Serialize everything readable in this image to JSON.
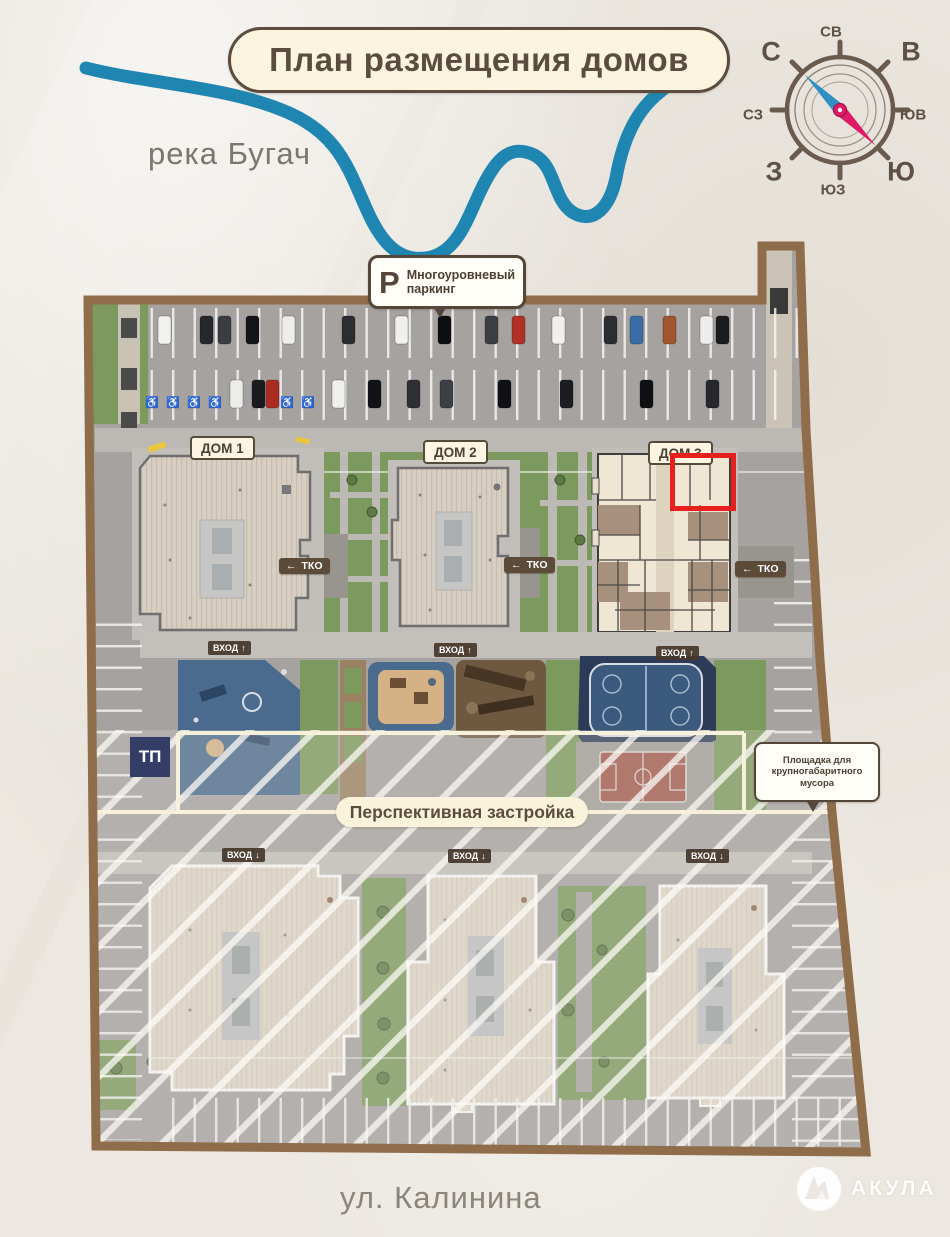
{
  "title": "План размещения домов",
  "labels": {
    "river": "река Бугач",
    "street": "ул. Калинина",
    "perspective": "Перспективная застройка",
    "tp": "ТП"
  },
  "compass": {
    "n": "С",
    "ne": "СВ",
    "e": "В",
    "se": "ЮВ",
    "s": "Ю",
    "sw": "ЮЗ",
    "w": "З",
    "nw": "СЗ"
  },
  "parking_callout": {
    "letter": "Р",
    "line1": "Многоуровневый",
    "line2": "паркинг"
  },
  "houses": [
    {
      "label": "ДОМ 1"
    },
    {
      "label": "ДОМ 2"
    },
    {
      "label": "ДОМ 3"
    }
  ],
  "entrance": {
    "label": "ВХОД",
    "up": "↑",
    "down": "↓"
  },
  "tko": {
    "arrow": "←",
    "label": "ТКО"
  },
  "bulky_waste": {
    "line1": "Площадка для",
    "line2": "крупногабаритного",
    "line3": "мусора"
  },
  "watermark": "АКУЛА",
  "colors": {
    "accent_red": "#e8201d",
    "compass_north": "#2d8fc2",
    "compass_south": "#de1b66",
    "border_brown": "#8f6d4a",
    "label_brown": "#5b4c40",
    "river_blue": "#1f86b2",
    "asphalt": "#a5a2a0",
    "grass": "#7c9a5e",
    "roof": "#d8cfc2",
    "paper": "#ece8e1"
  }
}
